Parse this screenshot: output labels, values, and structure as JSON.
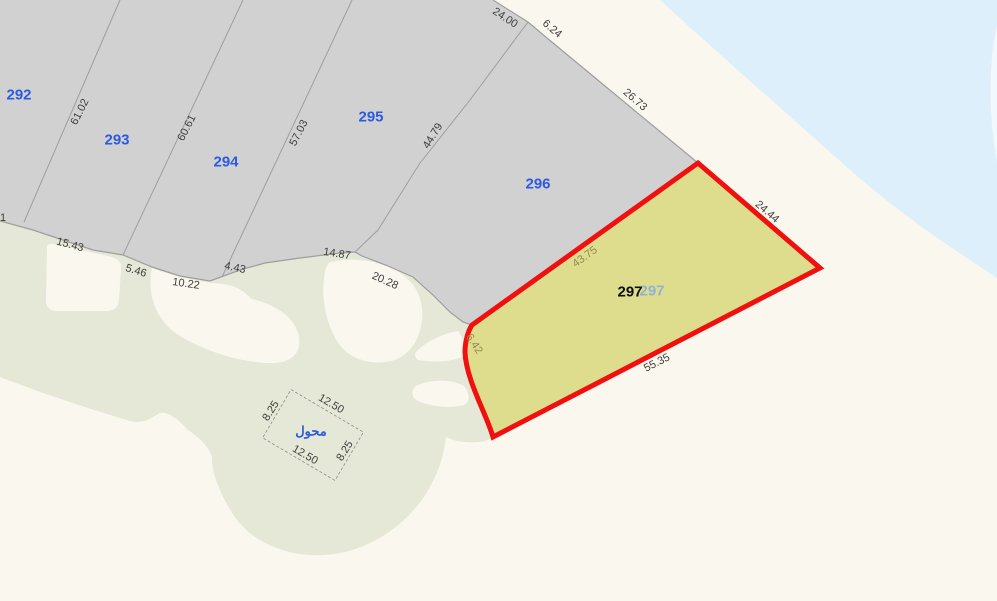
{
  "colors": {
    "sand": "#faf8ee",
    "water": "#ddeffb",
    "water_edge_highlight": "#f2f9fe",
    "parcel_gray": "#d1d1d1",
    "greenspace": "#e5e8d6",
    "boundary_line": "#9e9e9e",
    "highlight_fill": "#dedd8e",
    "highlight_border": "#f01010",
    "parcel_number_blue": "#2d5be0",
    "overlay_number_blue": "#8fb3d6",
    "dim_text": "#3e3e3e",
    "dim_text_olive": "#8e8a4e"
  },
  "parcel_labels": {
    "p292": "292",
    "p293": "293",
    "p294": "294",
    "p295": "295",
    "p296": "296",
    "p297": "297",
    "p297_overlay": "297"
  },
  "dimensions": {
    "d61_02": "61.02",
    "d60_61": "60.61",
    "d57_03": "57.03",
    "d44_79": "44.79",
    "d24_00": "24.00",
    "d6_24": "6.24",
    "d26_73": "26.73",
    "d24_44": "24.44",
    "d43_75": "43.75",
    "d6_42": "6.42",
    "d55_35": "55.35",
    "d15_43": "15.43",
    "d5_46": "5.46",
    "d10_22": "10.22",
    "d4_43": "4.43",
    "d14_87": "14.87",
    "d20_28": "20.28",
    "edge_partial": "1"
  },
  "transformer": {
    "label": "محول",
    "width_top": "12.50",
    "width_bottom": "12.50",
    "height_left": "8.25",
    "height_right": "8.25"
  }
}
